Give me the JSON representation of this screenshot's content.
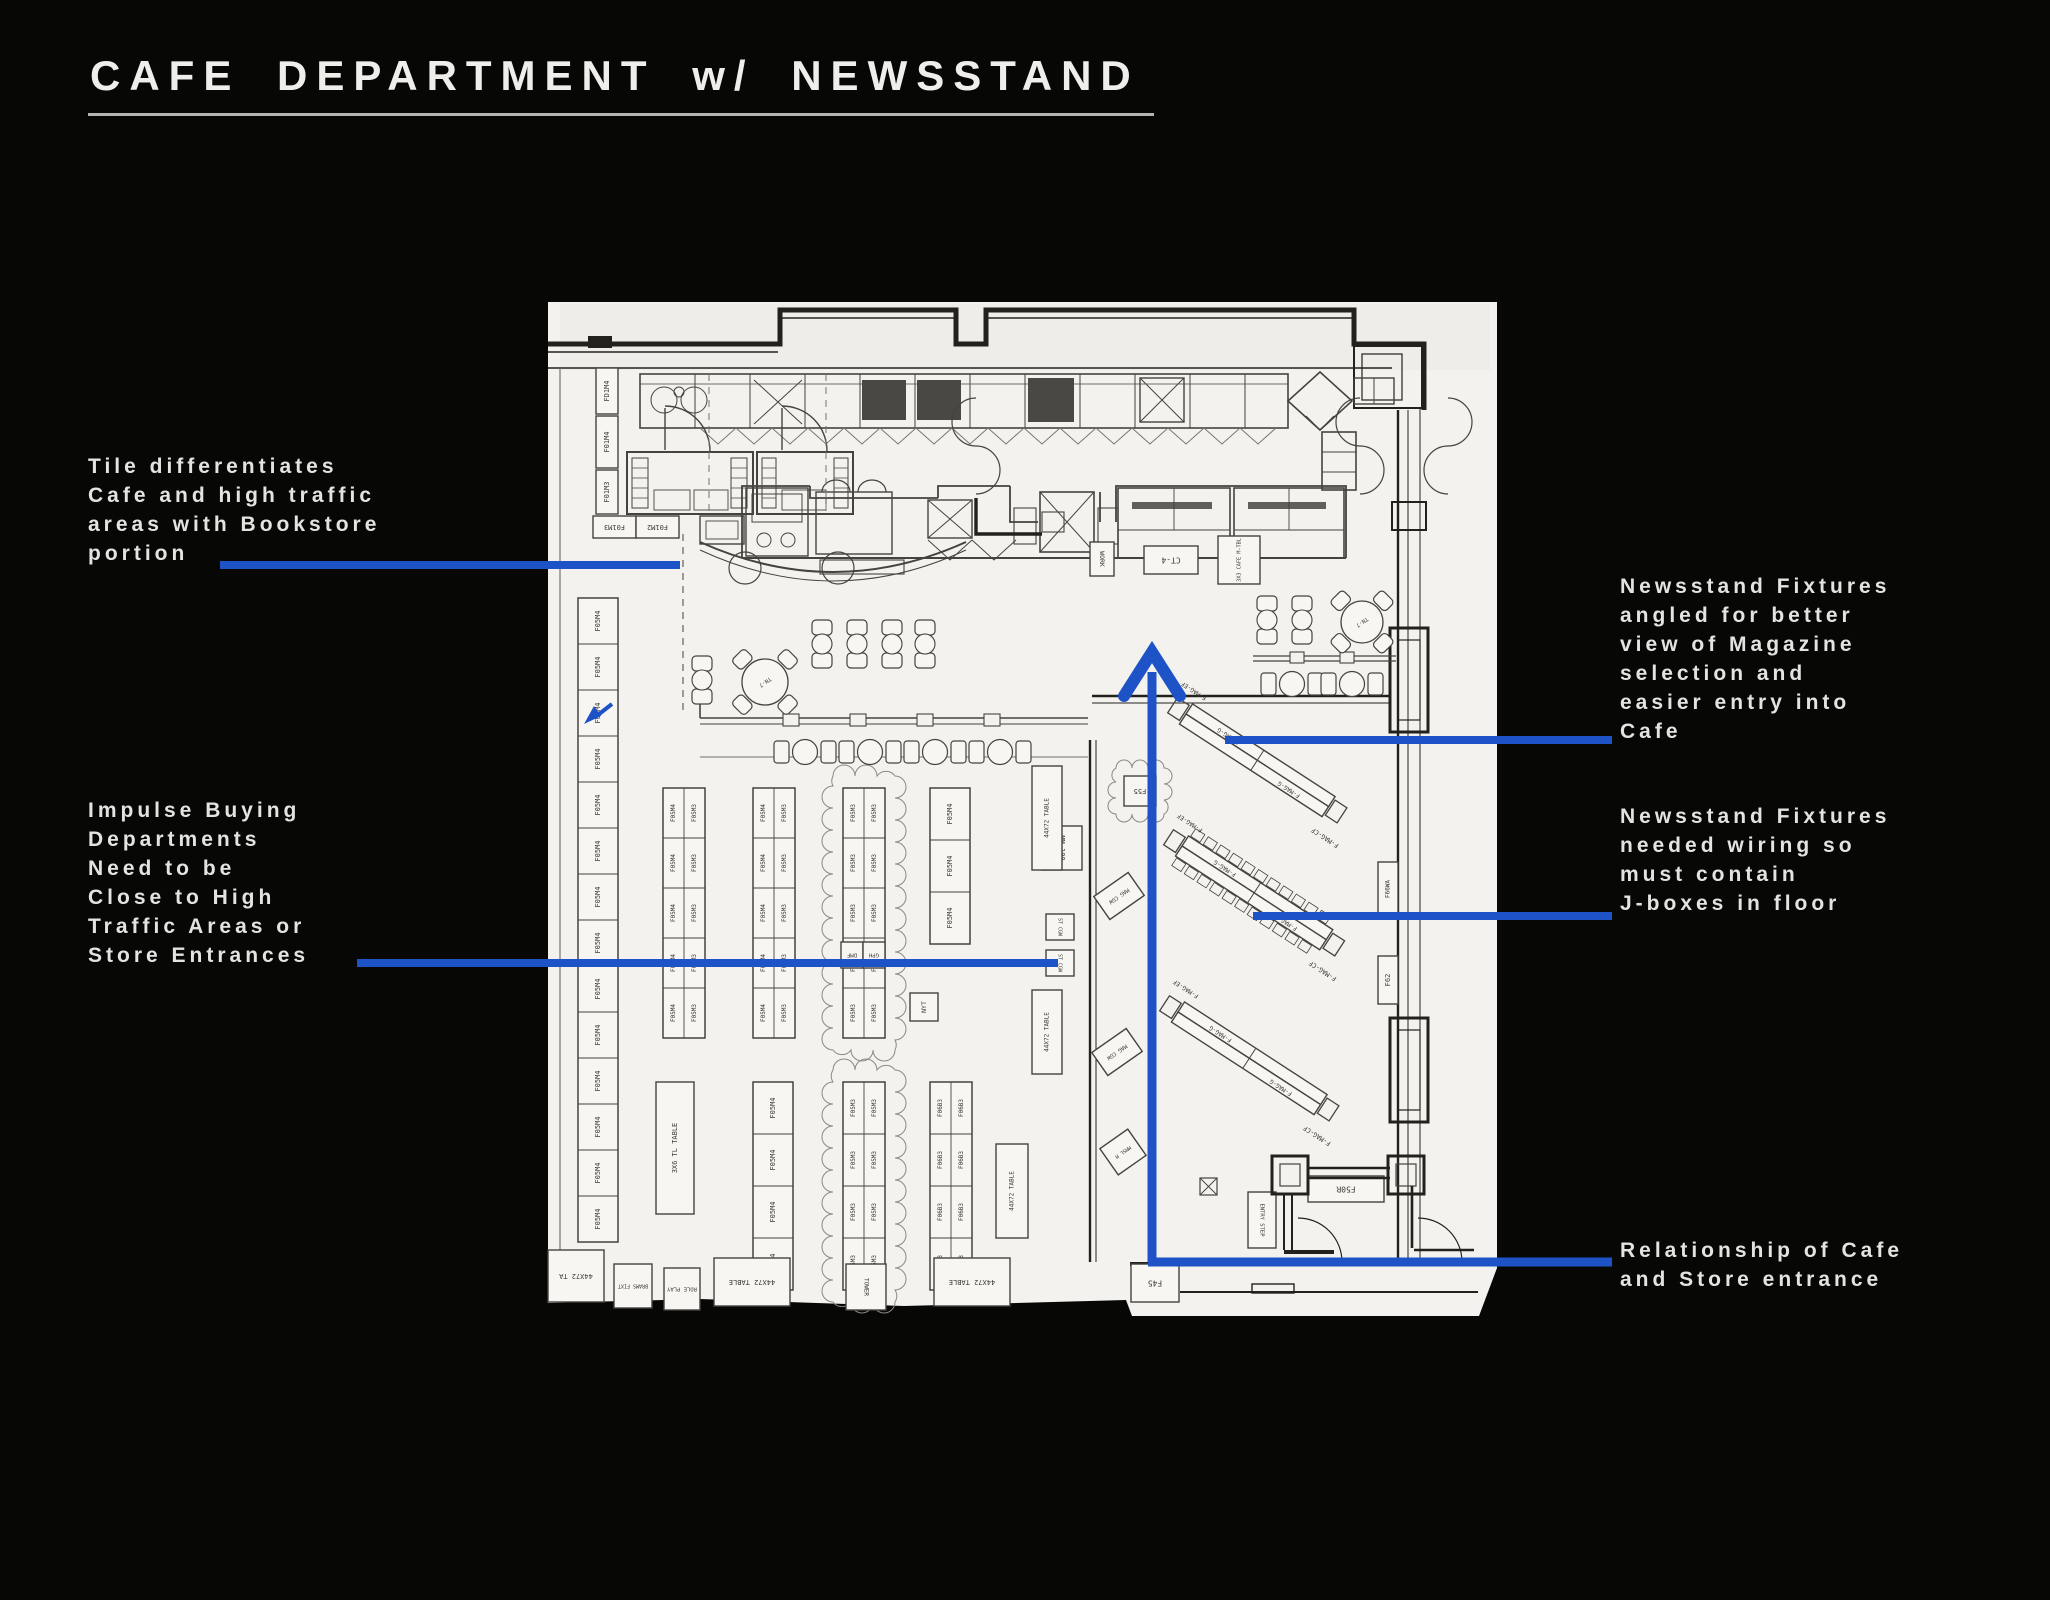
{
  "title": "CAFE DEPARTMENT w/ NEWSSTAND",
  "colors": {
    "annotation_blue": "#1d53c6",
    "plan_paper": "#f3f2ee",
    "ink": "#23211e"
  },
  "annotations": {
    "tile": {
      "lines": [
        "Tile differentiates",
        "Cafe and high traffic",
        "areas with Bookstore",
        "portion"
      ]
    },
    "impulse": {
      "lines": [
        "Impulse Buying",
        "Departments",
        "Need to be",
        "Close to High",
        "Traffic Areas or",
        "Store Entrances"
      ]
    },
    "angled": {
      "lines": [
        "Newsstand Fixtures",
        "angled for better",
        "view of Magazine",
        "selection and",
        "easier entry into",
        "Cafe"
      ]
    },
    "wiring": {
      "lines": [
        "Newsstand Fixtures",
        "needed wiring so",
        "must contain",
        "J-boxes in floor"
      ]
    },
    "relationship": {
      "lines": [
        "Relationship of Cafe",
        "and Store entrance"
      ]
    }
  },
  "plan": {
    "gondolas": [
      {
        "x": 578,
        "y": 598,
        "w": 40,
        "cellH": 46,
        "count": 14,
        "cols": [
          "F05M4"
        ],
        "cloud": false
      },
      {
        "x": 663,
        "y": 788,
        "w": 42,
        "cellH": 50,
        "count": 5,
        "cols": [
          "F05M4",
          "F05M3"
        ],
        "cloud": false
      },
      {
        "x": 753,
        "y": 788,
        "w": 42,
        "cellH": 50,
        "count": 5,
        "cols": [
          "F05M4",
          "F05M3"
        ],
        "cloud": false
      },
      {
        "x": 843,
        "y": 788,
        "w": 42,
        "cellH": 50,
        "count": 5,
        "cols": [
          "F05M3",
          "F05M3"
        ],
        "cloud": true
      },
      {
        "x": 930,
        "y": 788,
        "w": 40,
        "cellH": 52,
        "count": 3,
        "cols": [
          "F05M4"
        ],
        "cloud": false
      },
      {
        "x": 753,
        "y": 1082,
        "w": 40,
        "cellH": 52,
        "count": 4,
        "cols": [
          "F05M4"
        ],
        "cloud": false
      },
      {
        "x": 843,
        "y": 1082,
        "w": 42,
        "cellH": 52,
        "count": 4,
        "cols": [
          "F05M3",
          "F05M3"
        ],
        "cloud": true
      },
      {
        "x": 930,
        "y": 1082,
        "w": 42,
        "cellH": 52,
        "count": 4,
        "cols": [
          "F06B3",
          "F06B3"
        ],
        "cloud": false
      }
    ],
    "fixtures": [
      {
        "label": "FD1M4",
        "x": 596,
        "y": 368,
        "w": 22,
        "h": 46,
        "rot": -90,
        "fs": 7
      },
      {
        "label": "F01M4",
        "x": 596,
        "y": 416,
        "w": 22,
        "h": 52,
        "rot": -90,
        "fs": 7
      },
      {
        "label": "F01M3",
        "x": 596,
        "y": 470,
        "w": 22,
        "h": 44,
        "rot": -90,
        "fs": 7
      },
      {
        "label": "F01M3",
        "x": 593,
        "y": 516,
        "w": 43,
        "h": 22,
        "rot": 180,
        "fs": 7
      },
      {
        "label": "F01M2",
        "x": 636,
        "y": 516,
        "w": 43,
        "h": 22,
        "rot": 180,
        "fs": 7
      },
      {
        "label": "WORK",
        "x": 1090,
        "y": 542,
        "w": 24,
        "h": 34,
        "rot": 90,
        "fs": 6.5
      },
      {
        "label": "CT-4",
        "x": 1144,
        "y": 546,
        "w": 54,
        "h": 28,
        "rot": 180,
        "fs": 8
      },
      {
        "label": "3X3 CAFE M-TBL",
        "x": 1218,
        "y": 536,
        "w": 42,
        "h": 48,
        "rot": -90,
        "fs": 5.2
      },
      {
        "label": "MM 100",
        "x": 1042,
        "y": 826,
        "w": 40,
        "h": 44,
        "rot": 90,
        "fs": 7
      },
      {
        "label": "ST CGW",
        "x": 1046,
        "y": 914,
        "w": 28,
        "h": 26,
        "rot": 90,
        "fs": 5
      },
      {
        "label": "ST CGW",
        "x": 1046,
        "y": 950,
        "w": 28,
        "h": 26,
        "rot": 90,
        "fs": 5
      },
      {
        "label": "MAG CGW",
        "x": 1098,
        "y": 882,
        "w": 42,
        "h": 28,
        "rot": 180,
        "tilt": -35,
        "fs": 5.5
      },
      {
        "label": "MAG CGW",
        "x": 1096,
        "y": 1038,
        "w": 42,
        "h": 28,
        "rot": 180,
        "tilt": -35,
        "fs": 5.5
      },
      {
        "label": "MMSL M",
        "x": 1106,
        "y": 1136,
        "w": 34,
        "h": 32,
        "rot": 180,
        "tilt": -35,
        "fs": 5
      },
      {
        "label": "NYT",
        "x": 910,
        "y": 993,
        "w": 28,
        "h": 28,
        "rot": -90,
        "fs": 6.5
      },
      {
        "label": "F55",
        "x": 1124,
        "y": 776,
        "w": 32,
        "h": 30,
        "rot": 180,
        "cloud": true,
        "fs": 7
      },
      {
        "label": "F66WA",
        "x": 1378,
        "y": 862,
        "w": 20,
        "h": 54,
        "rot": -90,
        "fs": 6
      },
      {
        "label": "F62",
        "x": 1378,
        "y": 956,
        "w": 20,
        "h": 48,
        "rot": -90,
        "fs": 7
      },
      {
        "label": "F50R",
        "x": 1308,
        "y": 1176,
        "w": 76,
        "h": 26,
        "rot": 180,
        "fs": 8
      },
      {
        "label": "ENTRY STEP",
        "x": 1248,
        "y": 1192,
        "w": 28,
        "h": 56,
        "rot": 90,
        "fs": 5.5
      },
      {
        "label": "F45",
        "x": 1131,
        "y": 1264,
        "w": 48,
        "h": 38,
        "rot": 180,
        "fs": 8
      },
      {
        "label": "44X72 TABLE",
        "x": 1032,
        "y": 766,
        "w": 30,
        "h": 104,
        "rot": -90,
        "fs": 6
      },
      {
        "label": "44X72 TABLE",
        "x": 1032,
        "y": 990,
        "w": 30,
        "h": 84,
        "rot": -90,
        "fs": 6
      },
      {
        "label": "44X72 TABLE",
        "x": 996,
        "y": 1144,
        "w": 32,
        "h": 94,
        "rot": -90,
        "fs": 6
      },
      {
        "label": "44X72 TA",
        "x": 548,
        "y": 1250,
        "w": 56,
        "h": 52,
        "rot": 180,
        "fs": 7
      },
      {
        "label": "BRAMS FIXT",
        "x": 614,
        "y": 1264,
        "w": 38,
        "h": 44,
        "rot": 180,
        "fs": 5
      },
      {
        "label": "ROLE PLAY",
        "x": 664,
        "y": 1268,
        "w": 36,
        "h": 42,
        "rot": 180,
        "fs": 5.5
      },
      {
        "label": "44X72 TABLE",
        "x": 714,
        "y": 1258,
        "w": 76,
        "h": 48,
        "rot": 180,
        "fs": 7
      },
      {
        "label": "TOWER",
        "x": 846,
        "y": 1264,
        "w": 40,
        "h": 46,
        "rot": 90,
        "fs": 6
      },
      {
        "label": "44X72 TABLE",
        "x": 934,
        "y": 1258,
        "w": 76,
        "h": 48,
        "rot": 180,
        "fs": 7
      },
      {
        "label": "3X6 TL TABLE",
        "x": 656,
        "y": 1082,
        "w": 38,
        "h": 132,
        "rot": -90,
        "fs": 7
      },
      {
        "label": "DMF",
        "x": 841,
        "y": 942,
        "w": 22,
        "h": 26,
        "rot": 180,
        "fs": 5.5
      },
      {
        "label": "GPH",
        "x": 863,
        "y": 942,
        "w": 22,
        "h": 26,
        "rot": 180,
        "fs": 5.5
      }
    ],
    "mag_fixtures": [
      {
        "x": 1186,
        "y": 714,
        "len": 170,
        "angle": 33,
        "ticks": false,
        "label_in": "F-MAG-G",
        "label_end": "F-MAG-CF",
        "label_start": "F-MAG-EF"
      },
      {
        "x": 1182,
        "y": 846,
        "len": 172,
        "angle": 33,
        "ticks": true,
        "label_in": "F-MAG-G",
        "label_end": "F-MAG-CF",
        "label_start": "F-MAG-EF"
      },
      {
        "x": 1178,
        "y": 1012,
        "len": 170,
        "angle": 33,
        "ticks": false,
        "label_in": "F-MAG-G",
        "label_end": "F-MAG-CF",
        "label_start": "F-MAG-EF"
      }
    ],
    "seating": {
      "round_tables": [
        {
          "x": 765,
          "y": 682,
          "r": 23,
          "label": "TN-7"
        },
        {
          "x": 1362,
          "y": 622,
          "r": 21,
          "label": "TN-7"
        }
      ],
      "chair_pairs": [
        [
          822,
          644
        ],
        [
          857,
          644
        ],
        [
          892,
          644
        ],
        [
          925,
          644
        ],
        [
          702,
          680
        ],
        [
          1267,
          620
        ],
        [
          1302,
          620
        ]
      ],
      "table_groups": [
        [
          805,
          752
        ],
        [
          870,
          752
        ],
        [
          935,
          752
        ],
        [
          1000,
          752
        ],
        [
          1292,
          684
        ],
        [
          1352,
          684
        ]
      ]
    }
  }
}
